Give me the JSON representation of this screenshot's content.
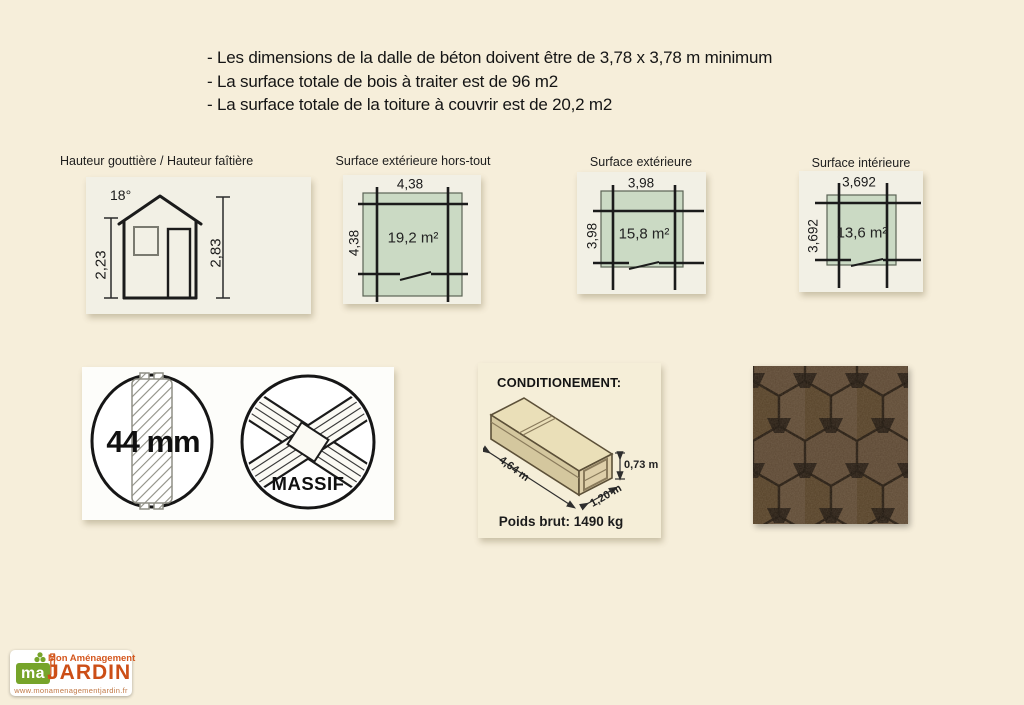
{
  "intro": {
    "lines": [
      "- Les dimensions de la dalle de béton doivent être de 3,78 x 3,78 m minimum",
      "- La surface totale de bois à traiter est de 96 m2",
      "- La surface totale de la toiture à couvrir est de 20,2 m2"
    ]
  },
  "diagrams": {
    "heights": {
      "title": "Hauteur gouttière / Hauteur faîtière",
      "roof_angle": "18°",
      "gutter_height": "2,23",
      "ridge_height": "2,83"
    },
    "exterior_overall": {
      "title": "Surface extérieure hors-tout",
      "width": "4,38",
      "depth": "4,38",
      "area": "19,2 m²"
    },
    "exterior": {
      "title": "Surface extérieure",
      "width": "3,98",
      "depth": "3,98",
      "area": "15,8 m²"
    },
    "interior": {
      "title": "Surface intérieure",
      "width": "3,692",
      "depth": "3,692",
      "area": "13,6 m²"
    }
  },
  "badges": {
    "thickness_label": "44 mm",
    "material_label": "MASSIF"
  },
  "packaging": {
    "title": "CONDITIONEMENT:",
    "length_label": "4,64 m",
    "width_label": "1,20 m",
    "height_label": "0,73 m",
    "weight_label": "Poids brut: 1490 kg"
  },
  "logo": {
    "monogram": "ma",
    "monogram_j": "j",
    "brand_line1": "Mon Aménagement",
    "brand_line2": "JARDIN",
    "url": "www.monamenagementjardin.fr"
  },
  "theme": {
    "page_bg": "#f6eeda",
    "panel_bg": "#f2f0e5",
    "plan_fill": "#cbdac4",
    "accent_orange": "#cc4e16",
    "logo_green": "#76a42a",
    "shingle_brown": "#57432f"
  }
}
